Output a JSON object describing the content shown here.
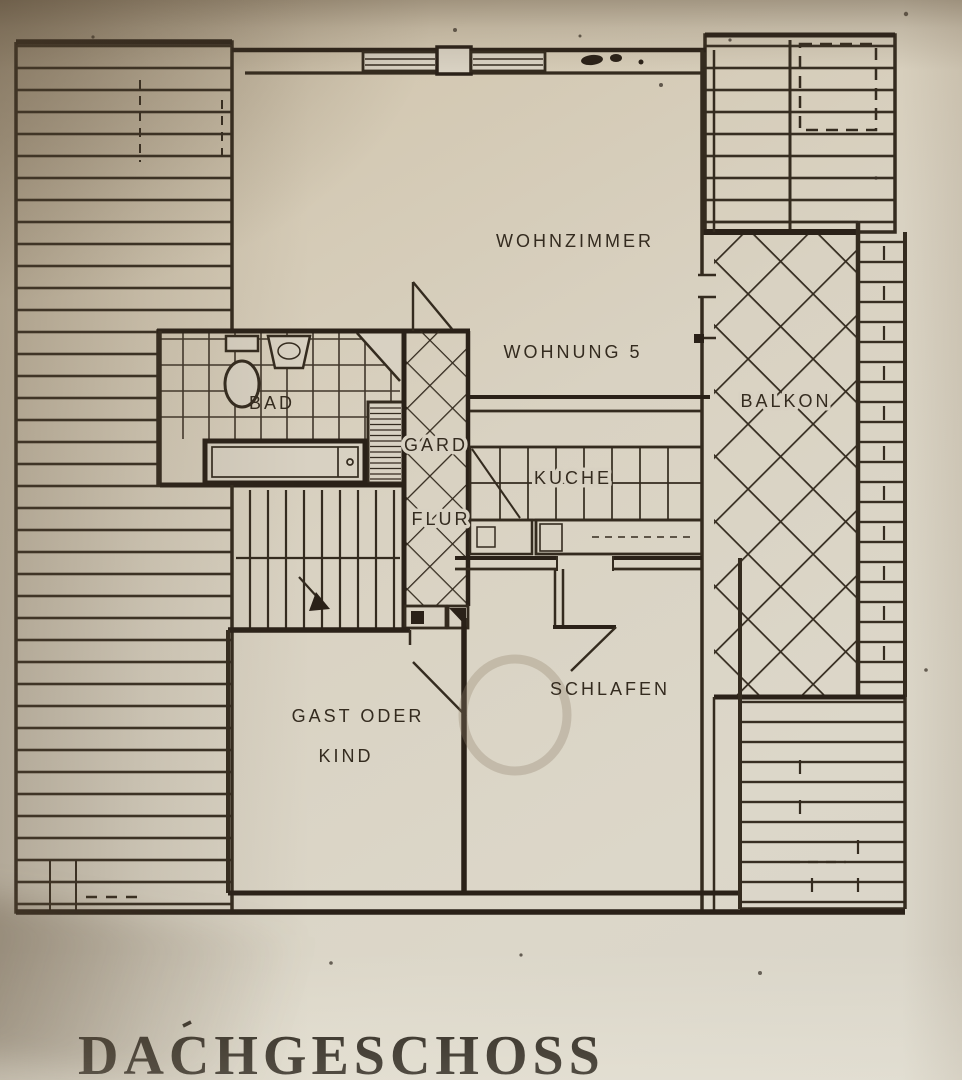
{
  "document": {
    "title": "DACHGESCHOSS"
  },
  "floor_plan": {
    "apartment": "WOHNUNG 5",
    "rooms": {
      "living_room": "WOHNZIMMER",
      "bathroom": "BAD",
      "wardrobe": "GARD",
      "hallway": "FLUR",
      "kitchen": "KUCHE",
      "balcony": "BALKON",
      "bedroom": "SCHLAFEN",
      "guest_room_line1": "GAST ODER",
      "guest_room_line2": "KIND"
    }
  },
  "colors": {
    "paper": "#d8d1c2",
    "ink": "#342b1f",
    "title_ink": "#221c13"
  }
}
